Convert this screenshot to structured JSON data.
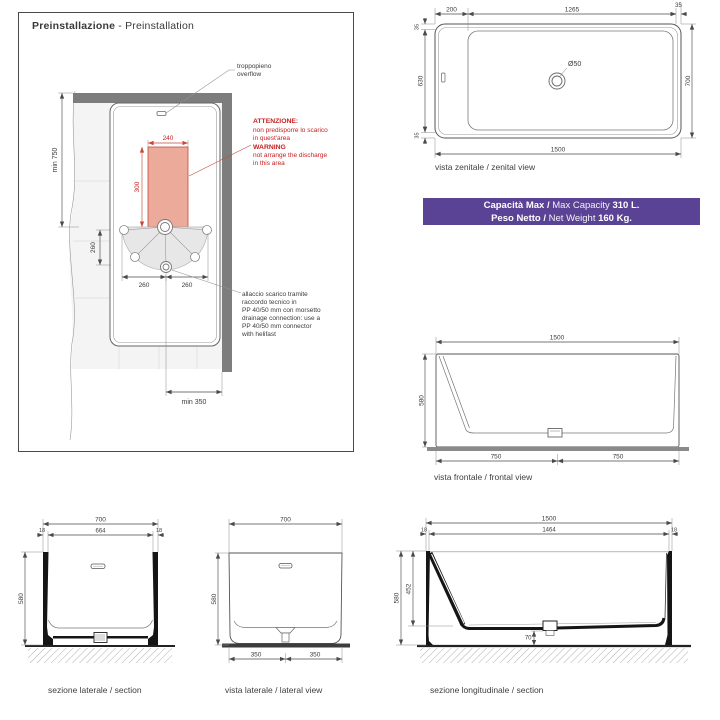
{
  "colors": {
    "accent_purple": "#5a4295",
    "warning_red": "#c42020",
    "exclusion_fill": "#ecab9a",
    "wall_gray": "#7d7d7d"
  },
  "preinstallation": {
    "title_bold": "Preinstallazione",
    "title_rest": " - Preinstallation",
    "overflow_it": "troppopieno",
    "overflow_en": "overflow",
    "warning": {
      "h_it": "ATTENZIONE:",
      "it1": "non predisporre lo scarico",
      "it2": "in quest'area",
      "h_en": "WARNING",
      "en1": "not arrange the discharge",
      "en2": "in this area"
    },
    "drain_note": [
      "allaccio scarico tramite",
      "raccordo tecnico in",
      "PP 40/50 mm con morsetto",
      "drainage connection: use a",
      "PP 40/50 mm connector",
      "with helifast"
    ],
    "dims": {
      "min_wall": "min 750",
      "rect_w": "240",
      "rect_h": "300",
      "v260": "260",
      "b260l": "260",
      "b260r": "260",
      "min_front": "min 350"
    }
  },
  "zenital": {
    "caption": "vista zenitale / zenital view",
    "dims": {
      "top_left": "200",
      "top_mid": "1265",
      "top_right": "35",
      "left_top": "35",
      "left_mid": "630",
      "left_bot": "35",
      "right": "700",
      "bottom": "1500",
      "drain": "Ø50"
    }
  },
  "banner": {
    "l1b": "Capacità Max /",
    "l1r": "Max Capacity",
    "l1v": "310 L.",
    "l2b": "Peso Netto /",
    "l2r": "Net Weight",
    "l2v": "160 Kg."
  },
  "frontal": {
    "caption": "vista frontale / frontal view",
    "dims": {
      "top": "1500",
      "left": "580",
      "bot_l": "750",
      "bot_r": "750"
    }
  },
  "section_lateral": {
    "caption": "sezione laterale / section",
    "dims": {
      "top": "700",
      "edge_l": "18",
      "inner": "664",
      "edge_r": "18",
      "left": "580"
    }
  },
  "lateral": {
    "caption": "vista laterale / lateral view",
    "dims": {
      "top": "700",
      "left": "580",
      "bot_l": "350",
      "bot_r": "350"
    }
  },
  "longitudinal": {
    "caption": "sezione longitudinale / section",
    "dims": {
      "top": "1500",
      "edge_l": "18",
      "inner": "1464",
      "edge_r": "18",
      "left": "580",
      "depth": "452",
      "drain_h": "70"
    }
  }
}
